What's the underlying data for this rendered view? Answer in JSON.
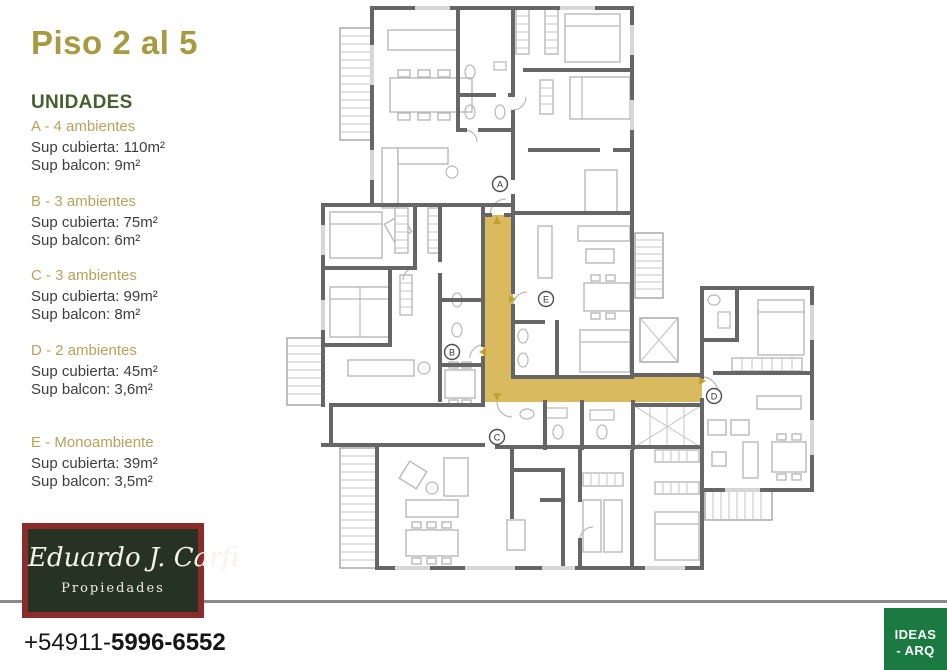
{
  "title": "Piso 2 al 5",
  "legend": {
    "heading": "UNIDADES",
    "units": [
      {
        "letter": "A",
        "label": "A - 4 ambientes",
        "sup_cubierta": "Sup cubierta: 110m²",
        "sup_balcon": "Sup balcon: 9m²"
      },
      {
        "letter": "B",
        "label": "B - 3 ambientes",
        "sup_cubierta": "Sup cubierta: 75m²",
        "sup_balcon": "Sup balcon: 6m²"
      },
      {
        "letter": "C",
        "label": "C - 3 ambientes",
        "sup_cubierta": "Sup cubierta: 99m²",
        "sup_balcon": "Sup balcon: 8m²"
      },
      {
        "letter": "D",
        "label": "D - 2 ambientes",
        "sup_cubierta": "Sup cubierta: 45m²",
        "sup_balcon": "Sup balcon: 3,6m²"
      },
      {
        "letter": "E",
        "label": "E - Monoambiente",
        "sup_cubierta": "Sup cubierta: 39m²",
        "sup_balcon": "Sup balcon: 3,5m²"
      }
    ]
  },
  "floorplan": {
    "markers": [
      {
        "letter": "A"
      },
      {
        "letter": "B"
      },
      {
        "letter": "C"
      },
      {
        "letter": "D"
      },
      {
        "letter": "E"
      }
    ]
  },
  "branding": {
    "agency_name": "Eduardo J. Carfi",
    "agency_subtitle": "Propiedades",
    "phone_prefix": "+54911-",
    "phone_number": "5996-6552"
  },
  "studio_badge": {
    "line1": "IDEAS",
    "line2": "- ARQ"
  },
  "colors": {
    "title": "#a89a40",
    "unit_label": "#b3a45c",
    "heading": "#44602e",
    "body_text": "#3e3e3e",
    "logo_border": "#8b2b2b",
    "logo_background": "#273322",
    "divider": "#8a8a8a",
    "badge": "#1b7a41",
    "corridor": "#d9ba5f"
  }
}
